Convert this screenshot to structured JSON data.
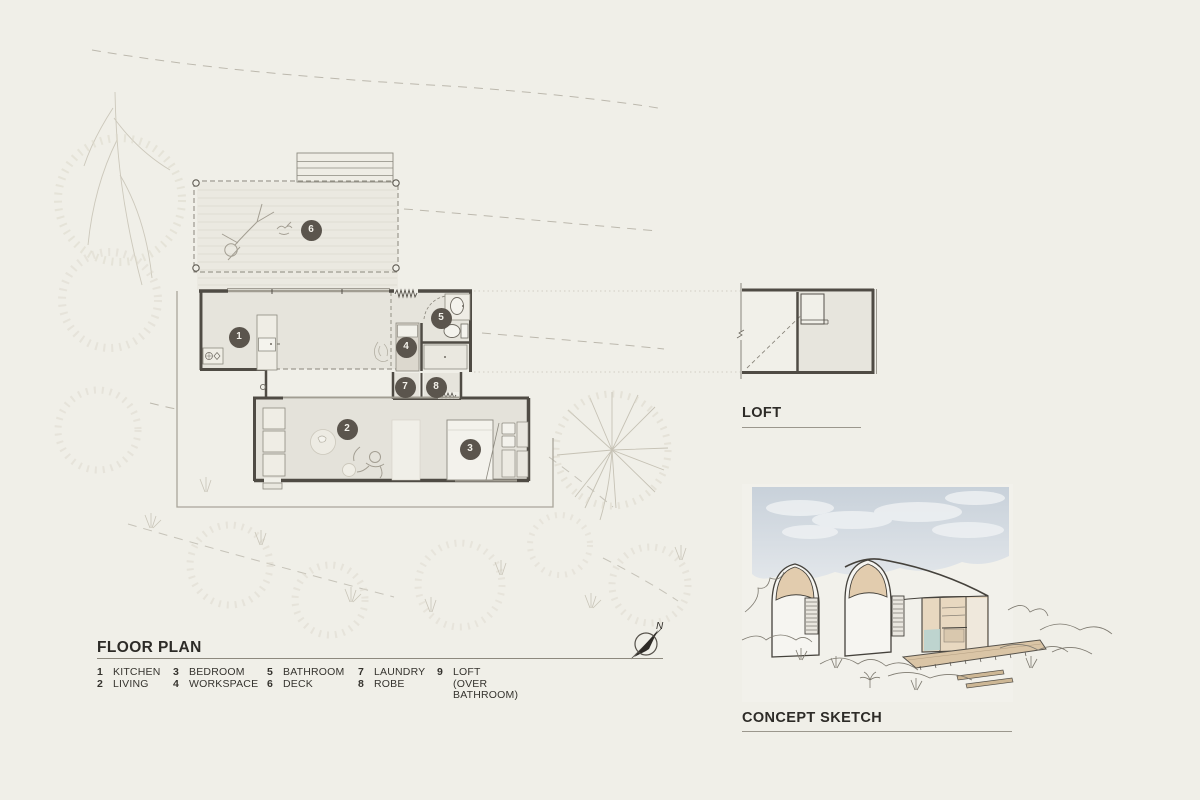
{
  "sheet": {
    "background": "#f0efe8"
  },
  "floor_plan": {
    "title": "FLOOR PLAN",
    "north_label": "N",
    "legend": [
      {
        "num": "1",
        "label": "KITCHEN"
      },
      {
        "num": "2",
        "label": "LIVING"
      },
      {
        "num": "3",
        "label": "BEDROOM"
      },
      {
        "num": "4",
        "label": "WORKSPACE"
      },
      {
        "num": "5",
        "label": "BATHROOM"
      },
      {
        "num": "6",
        "label": "DECK"
      },
      {
        "num": "7",
        "label": "LAUNDRY"
      },
      {
        "num": "8",
        "label": "ROBE"
      },
      {
        "num": "9",
        "label": "LOFT (OVER BATHROOM)"
      }
    ],
    "markers": {
      "kitchen": "1",
      "living": "2",
      "bedroom": "3",
      "workspace": "4",
      "bathroom": "5",
      "deck": "6",
      "laundry": "7",
      "robe": "8"
    }
  },
  "loft_plan": {
    "title": "LOFT"
  },
  "concept_sketch": {
    "title": "CONCEPT SKETCH"
  },
  "colors": {
    "background": "#f0efe8",
    "wall": "#4f4b44",
    "room_fill": "#e6e4dc",
    "marker": "#5b554d",
    "arch_tan": "#e2ccae",
    "sky": "#c9d2da",
    "glass_teal": "#b9d4d0",
    "deck_tan": "#dac5a6"
  }
}
